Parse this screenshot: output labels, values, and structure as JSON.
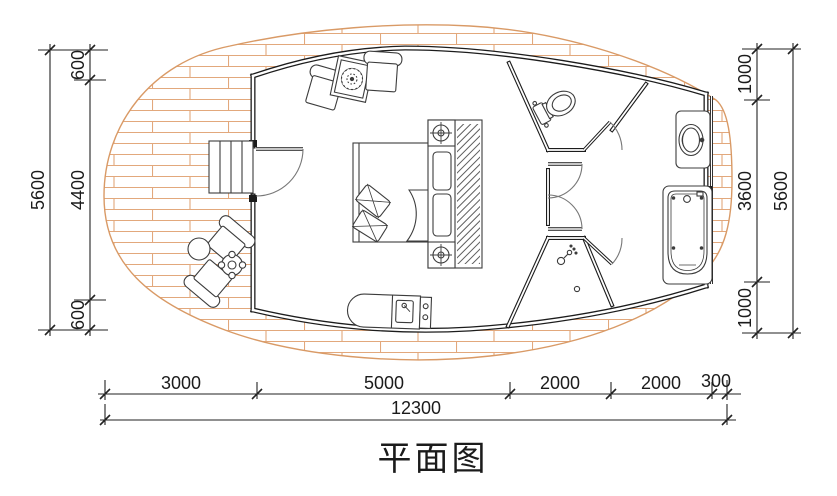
{
  "title": "平面图",
  "plan": {
    "type": "architectural-floor-plan",
    "hatch_color": "#e2a87c",
    "wall_color": "#1c1c1c",
    "rooms": [
      "wood-deck",
      "entry-steps",
      "bedroom",
      "toilet-room",
      "shower-room",
      "bathroom",
      "hallway"
    ],
    "furniture": [
      "outdoor-chairs",
      "outdoor-round-table",
      "potted-plant",
      "armchairs",
      "side-table-with-plant",
      "double-bed",
      "headboard-cabinet-with-lamps",
      "wardrobe",
      "kitchenette-counter",
      "toilet",
      "washbasin-vanity",
      "bathtub",
      "shower-head",
      "floor-drain"
    ]
  },
  "dimensions": {
    "left": {
      "segments": [
        "600",
        "4400",
        "600"
      ],
      "total": "5600"
    },
    "right": {
      "segments": [
        "1000",
        "3600",
        "1000"
      ],
      "total": "5600"
    },
    "bottom": {
      "segments": [
        "3000",
        "5000",
        "2000",
        "2000",
        "300"
      ],
      "total": "12300"
    }
  }
}
